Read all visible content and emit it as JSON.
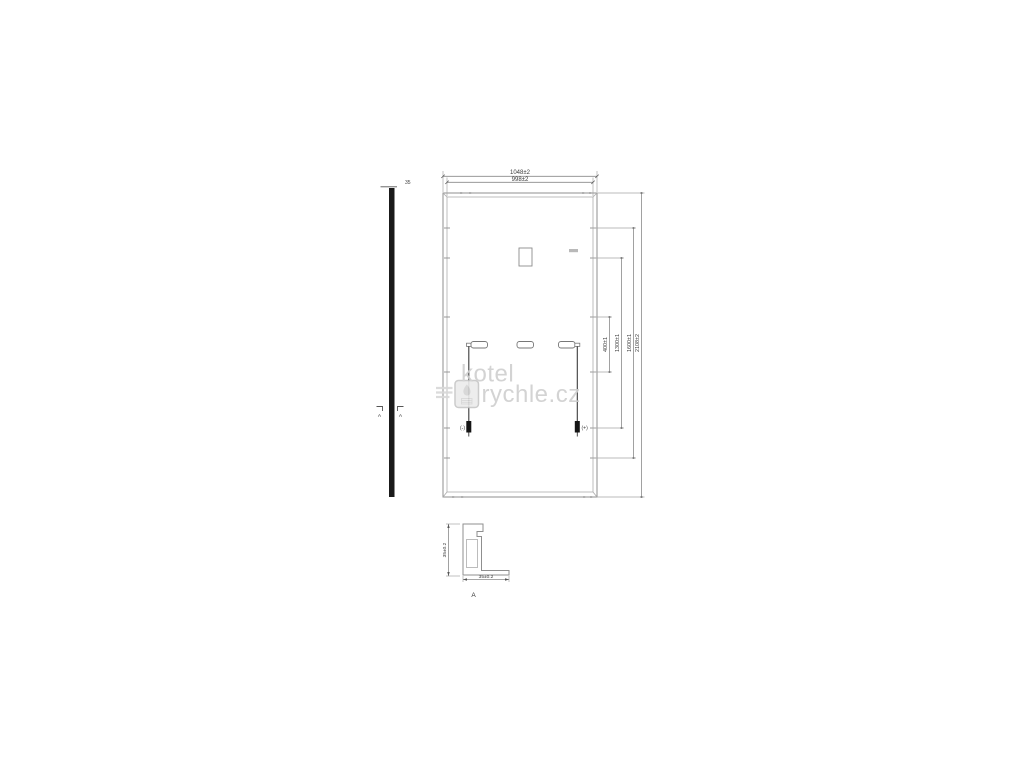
{
  "watermark": {
    "line1": "kotel",
    "line2": "rychle.cz",
    "logo": "boiler-flame-logo"
  },
  "side_view": {
    "thickness_label": "35",
    "section_label_left": "A",
    "section_label_right": "A"
  },
  "back_view": {
    "dim_width_outer": "1048±2",
    "dim_width_inner": "998±2",
    "dim_holes_inner": "400±1",
    "dim_holes_mid": "1300±1",
    "dim_holes_outer": "1600±1",
    "dim_height": "2108±2",
    "connector_negative_label": "(-)",
    "connector_positive_label": "(+)"
  },
  "section_detail": {
    "dim_height": "35±0.2",
    "dim_width": "35±0.2",
    "view_label": "A"
  },
  "colors": {
    "line": "#8f8f8f",
    "line_light": "#acacac",
    "text": "#3a3a3a",
    "solid_black": "#1a1a1a",
    "watermark_gray": "#cfcfcf",
    "background": "#ffffff"
  }
}
